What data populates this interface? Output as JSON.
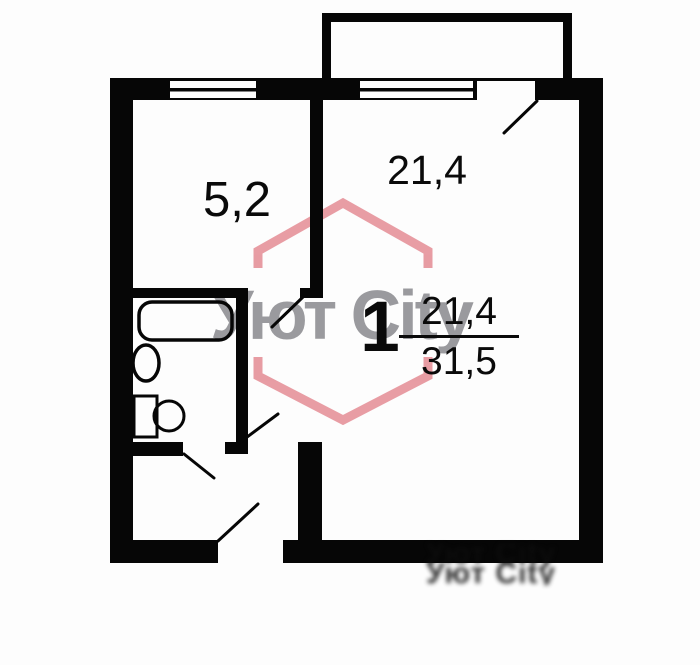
{
  "plan": {
    "rooms": {
      "kitchen": {
        "area": "5,2"
      },
      "living_room": {
        "area": "21,4"
      }
    },
    "stamp": {
      "rooms_count": "1",
      "living_area": "21,4",
      "total_area": "31,5"
    },
    "colors": {
      "wall": "#060606",
      "background": "#fdfdfd"
    }
  },
  "watermark": {
    "brand": "Уют City",
    "brand_color": "#9a9a9e",
    "hexagon_color": "#e2858d",
    "artifact": "Уют City Уют City"
  },
  "fixtures": [
    "bathtub",
    "toilet",
    "sink"
  ]
}
